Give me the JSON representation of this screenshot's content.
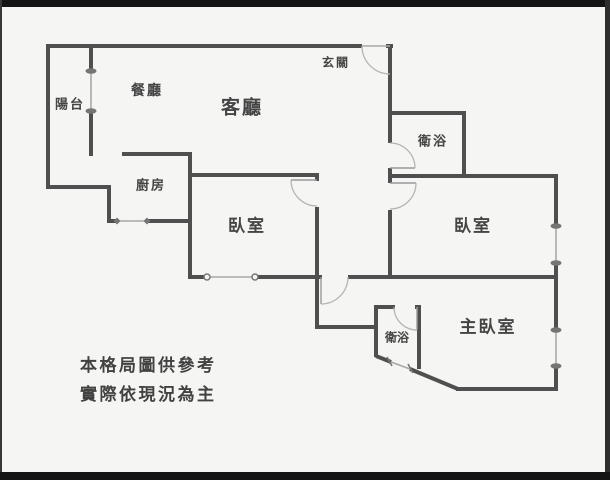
{
  "floorplan": {
    "rooms": {
      "balcony": {
        "label": "陽台"
      },
      "dining": {
        "label": "餐廳"
      },
      "living": {
        "label": "客廳"
      },
      "entry": {
        "label": "玄關"
      },
      "bath_upper": {
        "label": "衛浴"
      },
      "kitchen": {
        "label": "廚房"
      },
      "bedroom_left": {
        "label": "臥室"
      },
      "bedroom_right": {
        "label": "臥室"
      },
      "master_bedroom": {
        "label": "主臥室"
      },
      "bath_lower": {
        "label": "衛浴"
      }
    },
    "disclaimer": {
      "line1": "本格局圖供參考",
      "line2": "實際依現況為主"
    },
    "colors": {
      "wall": "#4f4f4f",
      "window_line": "#a8a8a8",
      "door_arc": "#b5b5b5",
      "door_leaf": "#9a9a9a",
      "marker": "#757575",
      "text": "#454545",
      "background": "#f5f5f3",
      "frame_bar": "#141414"
    }
  }
}
